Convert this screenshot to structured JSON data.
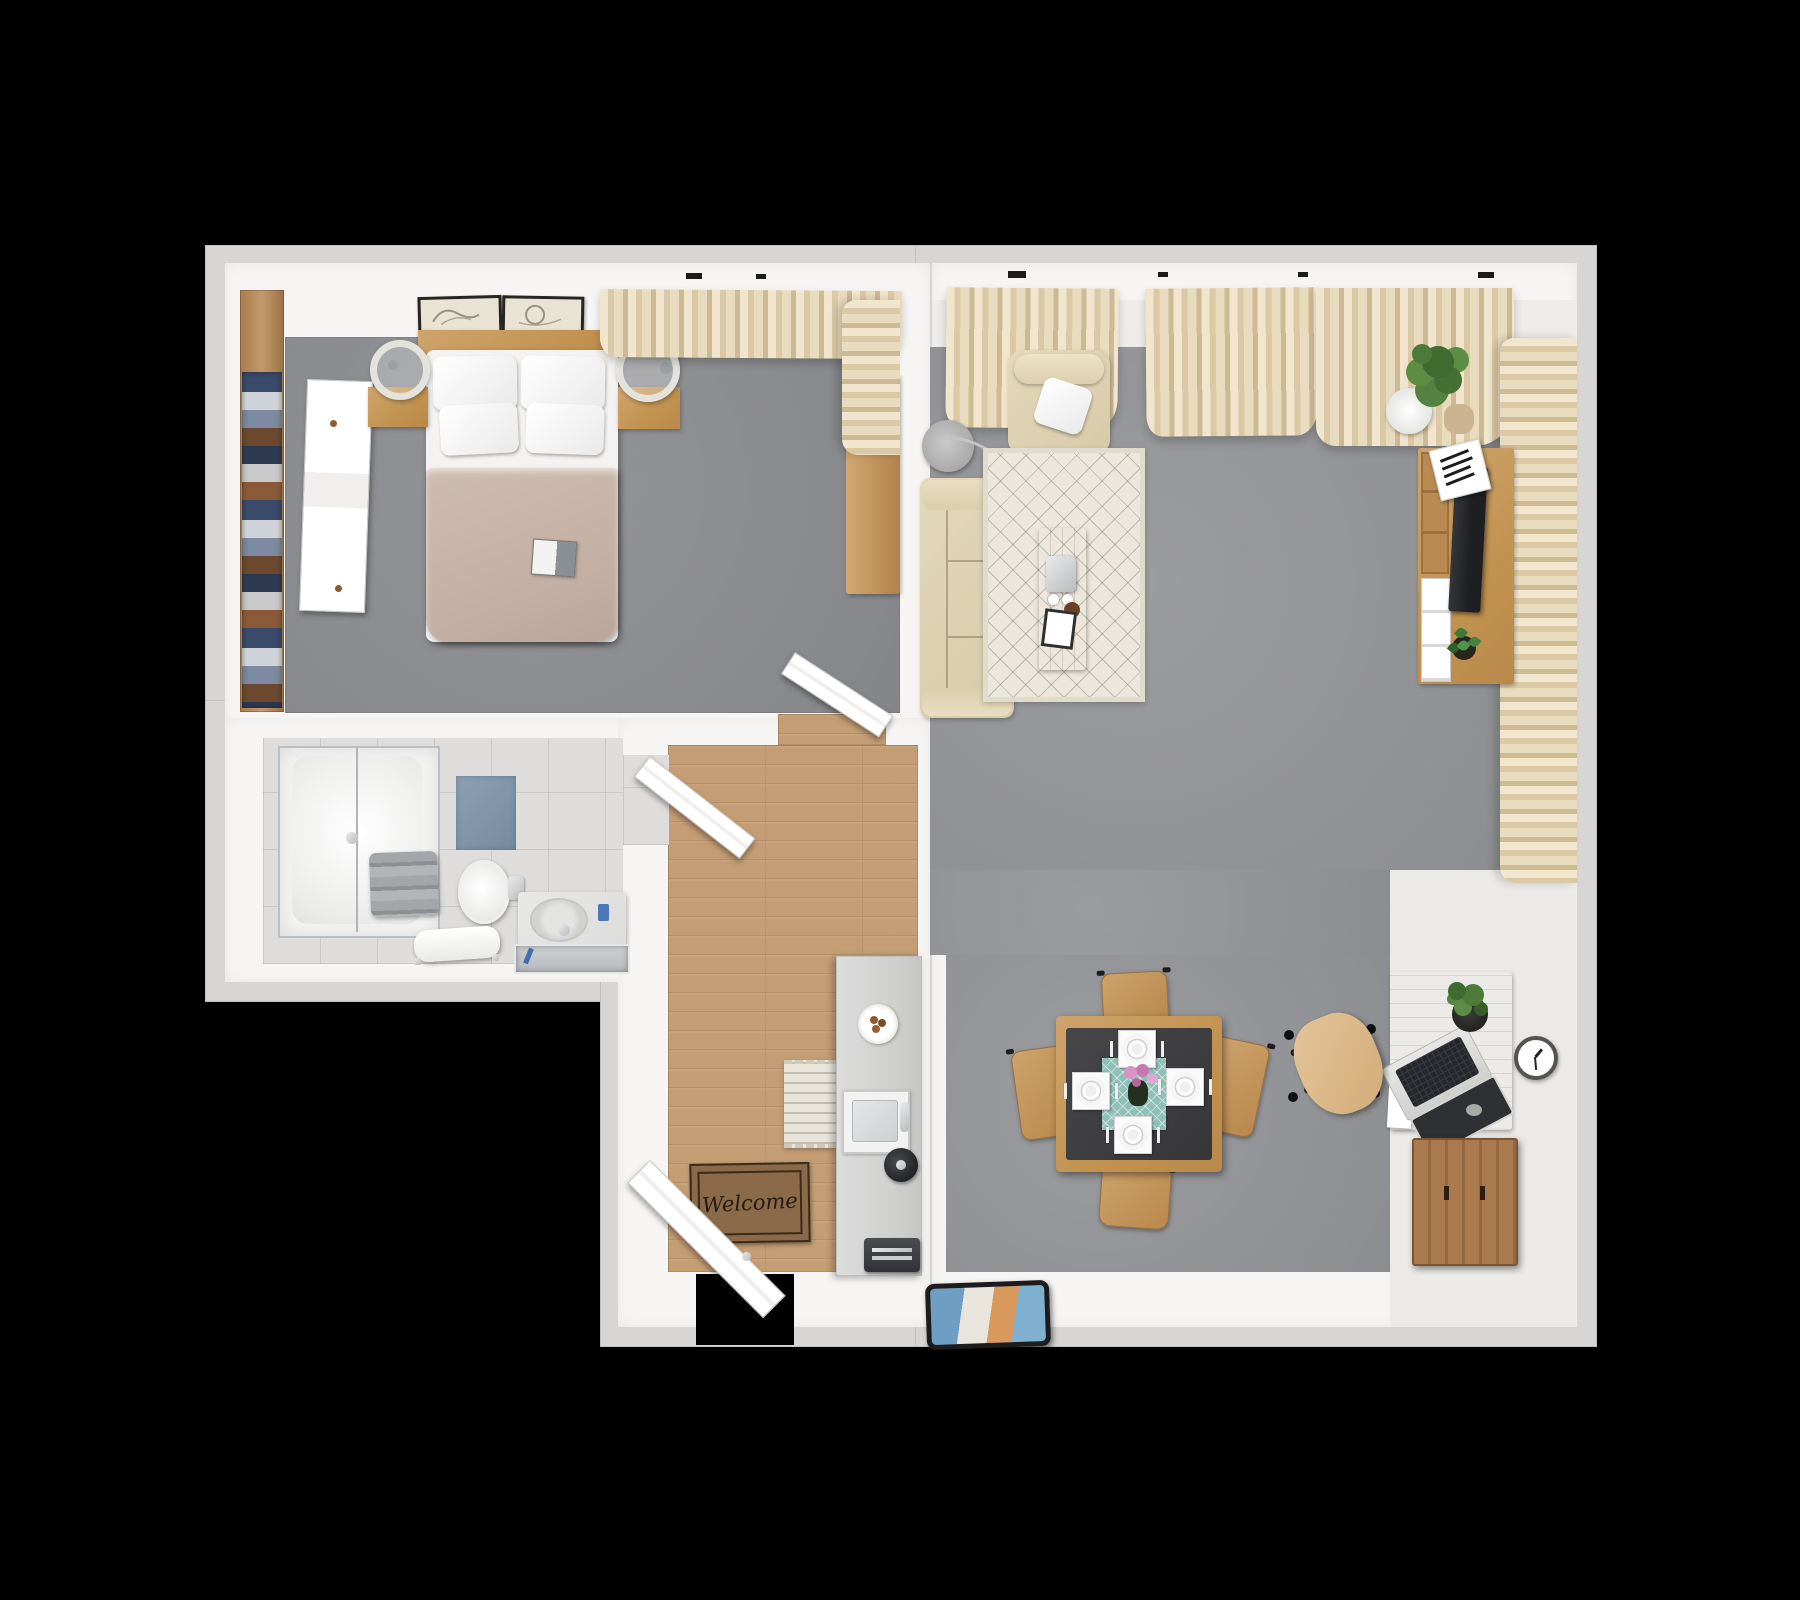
{
  "scene": {
    "title": "3D apartment floor plan, top-down render on black background",
    "background_color": "#000000"
  },
  "entry": {
    "welcome_mat_text": "Welcome"
  },
  "palette": {
    "wall": "#f6f5f3",
    "slab_outline": "#d7d6d4",
    "bedroom_carpet": "#8d8e91",
    "living_carpet": "#97989b",
    "wood_floor": "#c49d74",
    "furniture_wood": "#c59a63",
    "curtain": "#e6d9bc",
    "bathroom_tile": "#dedddb",
    "bath_mat_blue": "#8196a9",
    "table_runner_teal": "#8fc0b8",
    "flowers_pink": "#d892c4",
    "plant_green": "#4c7a38",
    "welcome_mat_brown": "#8a6a48",
    "blanket_beige": "#c7b4a8"
  },
  "rooms": [
    {
      "name": "bedroom",
      "floor": "gray carpet",
      "furniture": [
        "double bed with white pillows and beige blanket",
        "wood headboard",
        "two framed wall artworks",
        "left nightstand with round lamp",
        "right nightstand with round lamp",
        "open wardrobe with hanging clothes",
        "white sliding wardrobe door",
        "tall wood dresser",
        "beige window curtain",
        "magazine on bed"
      ]
    },
    {
      "name": "bathroom",
      "floor": "light gray tile",
      "furniture": [
        "glass walk-in shower",
        "stack of gray towels",
        "blue bath mat",
        "toilet with paper holder",
        "towel bench",
        "stone vanity with oval sink, faucet and trough tub"
      ]
    },
    {
      "name": "entry-hall-kitchen",
      "floor": "wood planks",
      "furniture": [
        "open entry door",
        "welcome mat",
        "patterned runner rug",
        "narrow kitchen counter",
        "plate of cookies",
        "square kitchen sink with faucet",
        "black kettle",
        "dark toaster"
      ]
    },
    {
      "name": "living-room",
      "floor": "gray carpet with white border",
      "furniture": [
        "beige sofa",
        "beige armchair with white throw pillow",
        "arc floor lamp",
        "cream diamond-pattern rug",
        "wood coffee table with espresso maker, cups and card",
        "wood tv cabinet with tv, magazines, drawers and small plant",
        "potted plant on white stand",
        "square dining table with four place settings and pink flowers",
        "four wood dining chairs",
        "wood desk with laptop, plant, paper and pebble",
        "office chair with black star base",
        "slatted wood sideboard",
        "round wall clock",
        "tablet lying near wall",
        "beige window curtains along north and east walls"
      ]
    }
  ]
}
